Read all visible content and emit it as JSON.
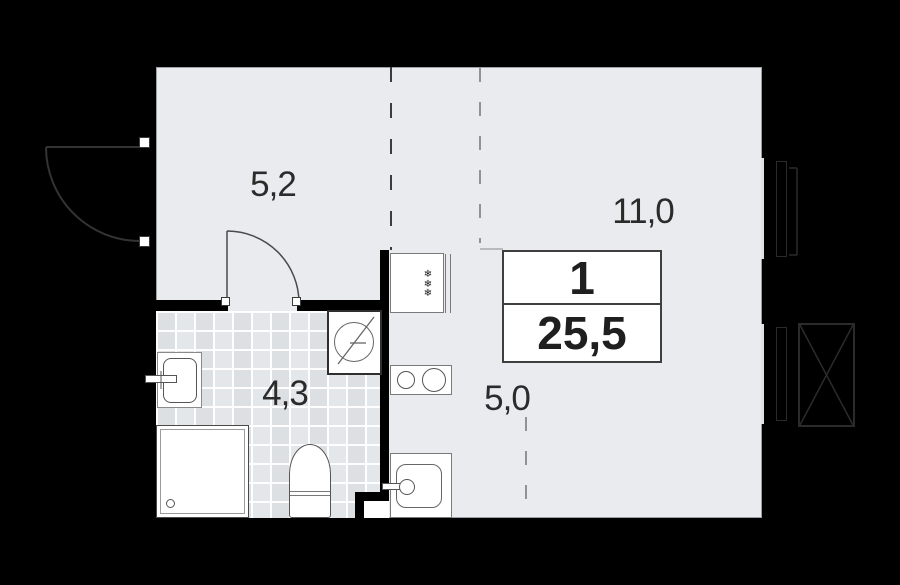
{
  "plan": {
    "badge": {
      "rooms_count": "1",
      "total_area": "25,5"
    },
    "rooms": {
      "hallway": {
        "area": "5,2"
      },
      "living": {
        "area": "11,0"
      },
      "bathroom": {
        "area": "4,3"
      },
      "kitchen": {
        "area": "5,0"
      }
    },
    "icons": {
      "fridge_snowflake": "❄"
    },
    "colors": {
      "background": "#000000",
      "floor": "#e9ebee",
      "tiles": "#e4e7ea",
      "walls": "#000000",
      "fixture_outline": "#555555",
      "dashed_zone_line": "#757575",
      "window_line": "#2b2b2b"
    }
  }
}
